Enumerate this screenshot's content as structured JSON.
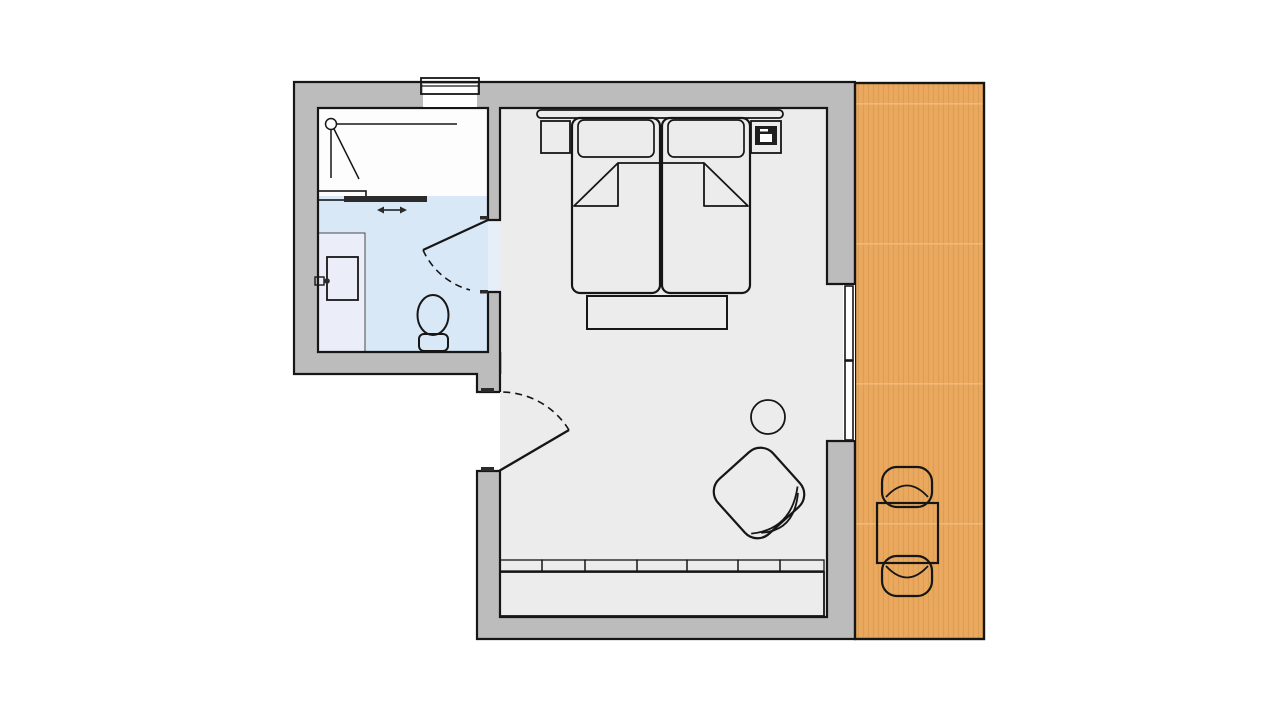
{
  "plan": {
    "kind": "hotel-room-floor-plan",
    "rooms": [
      {
        "name": "bathroom",
        "fixtures": [
          "shower",
          "shower-sliding-door",
          "washbasin",
          "faucet",
          "toilet",
          "swing-door",
          "exterior-window"
        ]
      },
      {
        "name": "bedroom",
        "fixtures": [
          "headboard",
          "double-bed",
          "pillow-left",
          "pillow-right",
          "duvet-folds",
          "nightstand-left",
          "nightstand-right",
          "telephone",
          "foot-bench",
          "armchair",
          "side-table",
          "wardrobe",
          "entrance-door",
          "window-front"
        ]
      },
      {
        "name": "terrace",
        "fixtures": [
          "wood-decking",
          "outdoor-table",
          "outdoor-chair-top",
          "outdoor-chair-bottom"
        ]
      }
    ]
  },
  "colors": {
    "background": "#ffffff",
    "wall_fill": "#bcbcbc",
    "outline": "#161616",
    "bedroom_floor": "#ececec",
    "bathroom_floor": "#d8e8f6",
    "vanity_floor": "#ebedf8",
    "doorway_floor": "#e6eef8",
    "shower_white": "#fdfdfd",
    "terrace_wood": "#eaa95f",
    "wood_stripe": "#cf8f45",
    "wood_seam": "#f4bd7d",
    "furniture_tan": "#e6c9a2",
    "wardrobe_body": "#dfc39d",
    "wardrobe_door": "#ecdabb",
    "bench_green": "#dfe5dd",
    "armchair_green": "#e4e9e3",
    "sheet_blue": "#dcebf8",
    "dark": "#2b2b2b",
    "white": "#ffffff"
  }
}
